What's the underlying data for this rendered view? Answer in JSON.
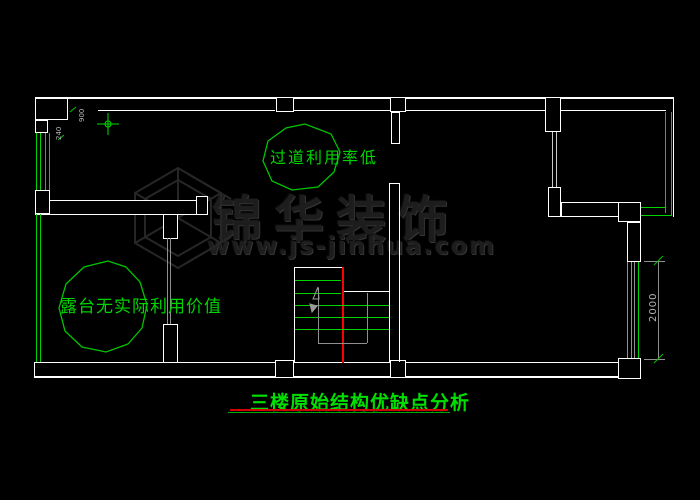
{
  "annotations": {
    "corridor": "过道利用率低",
    "terrace": "露台无实际利用价值"
  },
  "title": {
    "text": "三楼原始结构优缺点分析"
  },
  "watermark": {
    "brand": "锦华装饰",
    "url": "www.js-jinhua.com"
  },
  "dims": {
    "right": "2000",
    "a": "240",
    "b": "900"
  },
  "colors": {
    "bg": "#000000",
    "wall": "#ffffff",
    "green": "#00d400",
    "title": "#00e000",
    "red": "#ff0000",
    "underline_red": "#d40000",
    "underline_green": "#00a800",
    "gray": "#909090",
    "wm": "#1d1d1d"
  }
}
